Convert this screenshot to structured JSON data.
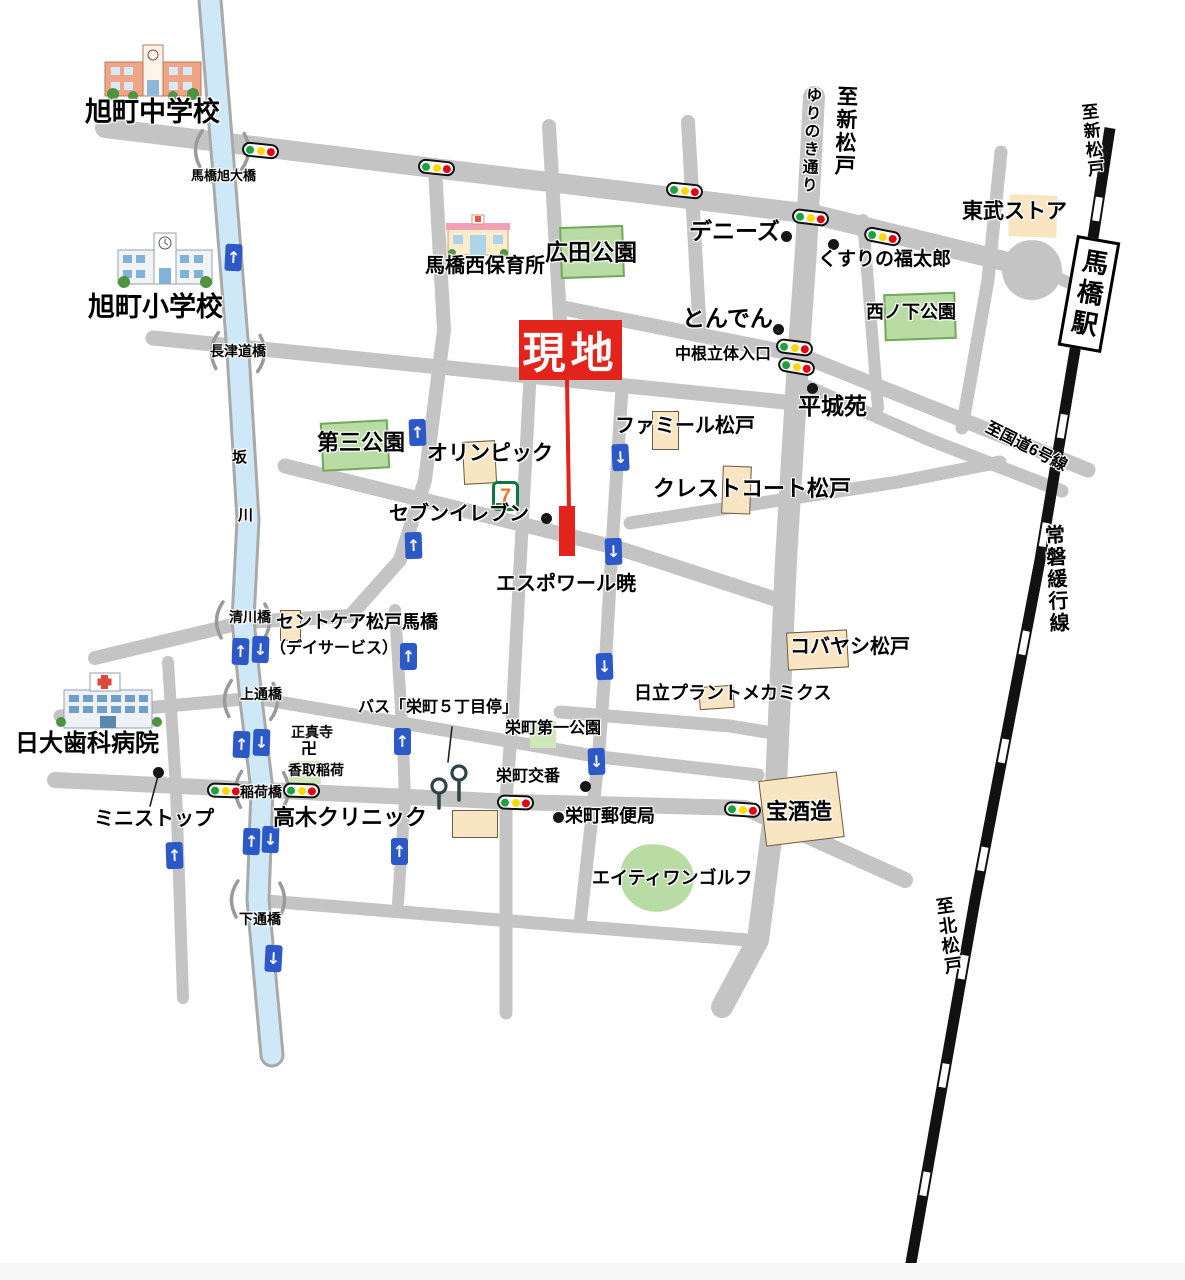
{
  "colors": {
    "road": "#c4c4c4",
    "river_fill": "#cfe8f7",
    "river_edge": "#a9a9a9",
    "rail": "#111111",
    "park_fill": "#b9dba4",
    "park_border": "#74a85e",
    "park_fill_light": "#cfe7b9",
    "building_fill": "#fae5c3",
    "building_border": "#6b5b45",
    "site_red": "#e2241d",
    "arrow_blue": "#2d59c8",
    "light_green": "#1ca23c",
    "light_yellow": "#ffd800",
    "light_red": "#e60012",
    "text": "#000000"
  },
  "site": {
    "label": "現地",
    "x": 519,
    "y": 320,
    "w": 103,
    "h": 60
  },
  "station": {
    "label": "馬橋駅",
    "x": 1067,
    "y": 238,
    "w": 44,
    "h": 112,
    "r": 10
  },
  "labels": [
    {
      "n": "asahicho-junior-high-label",
      "t": "旭町中学校",
      "x": 85,
      "y": 98,
      "s": 27
    },
    {
      "n": "asahicho-elementary-label",
      "t": "旭町小学校",
      "x": 88,
      "y": 293,
      "s": 27
    },
    {
      "n": "mabashi-asahi-ohashi-label",
      "t": "馬橋旭大橋",
      "x": 191,
      "y": 169,
      "s": 13
    },
    {
      "n": "mabashi-nishi-hoikusho-label",
      "t": "馬橋西保育所",
      "x": 425,
      "y": 256,
      "s": 20
    },
    {
      "n": "hirota-park-label",
      "t": "広田公園",
      "x": 545,
      "y": 240,
      "s": 23
    },
    {
      "n": "dennys-label",
      "t": "デニーズ",
      "x": 689,
      "y": 219,
      "s": 23
    },
    {
      "n": "yurinoki-street-label",
      "t": "ゆりのき通り",
      "x": 803,
      "y": 86,
      "s": 16,
      "v": 1,
      "r": 3
    },
    {
      "n": "to-shin-matsudo-road-label",
      "t": "至新松戸",
      "x": 835,
      "y": 85,
      "s": 21,
      "v": 1,
      "r": 2
    },
    {
      "n": "kusuri-no-fukutaro-label",
      "t": "くすりの福太郎",
      "x": 818,
      "y": 250,
      "s": 19
    },
    {
      "n": "tobu-store-label",
      "t": "東武ストア",
      "x": 962,
      "y": 201,
      "s": 21
    },
    {
      "n": "tonden-label",
      "t": "とんでん",
      "x": 682,
      "y": 306,
      "s": 23
    },
    {
      "n": "nakane-rittai-entrance-label",
      "t": "中根立体入口",
      "x": 675,
      "y": 347,
      "s": 16
    },
    {
      "n": "nishinoshita-park-label",
      "t": "西ノ下公園",
      "x": 866,
      "y": 303,
      "s": 18
    },
    {
      "n": "heijoen-label",
      "t": "平城苑",
      "x": 798,
      "y": 394,
      "s": 23
    },
    {
      "n": "to-route6-label",
      "t": "至国道6号線",
      "x": 990,
      "y": 420,
      "s": 16,
      "r": 27
    },
    {
      "n": "famille-matsudo-label",
      "t": "ファミール松戸",
      "x": 615,
      "y": 416,
      "s": 20
    },
    {
      "n": "daisan-park-label",
      "t": "第三公園",
      "x": 317,
      "y": 431,
      "s": 22
    },
    {
      "n": "olympic-label",
      "t": "オリンピック",
      "x": 427,
      "y": 443,
      "s": 21
    },
    {
      "n": "crest-court-matsudo-label",
      "t": "クレストコート松戸",
      "x": 653,
      "y": 477,
      "s": 22
    },
    {
      "n": "seven-eleven-label",
      "t": "セブンイレブン",
      "x": 389,
      "y": 504,
      "s": 20
    },
    {
      "n": "espoir-akatsuki-label",
      "t": "エスポワール暁",
      "x": 496,
      "y": 574,
      "s": 20
    },
    {
      "n": "joban-local-line-label",
      "t": "常磐緩行線",
      "x": 1041,
      "y": 525,
      "s": 20,
      "v": 1,
      "r": -3
    },
    {
      "n": "saintcare-matsudo-mabashi-label",
      "t": "セントケア松戸馬橋",
      "x": 276,
      "y": 613,
      "s": 18
    },
    {
      "n": "dayservice-label",
      "t": "（デイサービス）",
      "x": 270,
      "y": 641,
      "s": 16
    },
    {
      "n": "kiyokawa-bridge-label",
      "t": "清川橋",
      "x": 229,
      "y": 610,
      "s": 14
    },
    {
      "n": "nagatsudo-bridge-label",
      "t": "長津道橋",
      "x": 210,
      "y": 344,
      "s": 14
    },
    {
      "n": "kobayashi-matsudo-label",
      "t": "コバヤシ松戸",
      "x": 790,
      "y": 637,
      "s": 20
    },
    {
      "n": "hitachi-plant-mechanics-label",
      "t": "日立プラントメカミクス",
      "x": 634,
      "y": 684,
      "s": 18
    },
    {
      "n": "kamitsuri-bridge-label",
      "t": "上通橋",
      "x": 240,
      "y": 687,
      "s": 14
    },
    {
      "n": "shoshinji-temple-label",
      "t": "正真寺",
      "x": 291,
      "y": 725,
      "s": 14
    },
    {
      "n": "manji-symbol",
      "t": "卍",
      "x": 301,
      "y": 742,
      "s": 16
    },
    {
      "n": "katori-inari-label",
      "t": "香取稲荷",
      "x": 288,
      "y": 763,
      "s": 14
    },
    {
      "n": "bus-sakaemachi-5chome-stop-label",
      "t": "バス「栄町５丁目停」",
      "x": 358,
      "y": 700,
      "s": 16
    },
    {
      "n": "sakaemachi-daiichi-park-label",
      "t": "栄町第一公園",
      "x": 505,
      "y": 721,
      "s": 16
    },
    {
      "n": "nichidai-dental-hospital-label",
      "t": "日大歯科病院",
      "x": 15,
      "y": 731,
      "s": 24
    },
    {
      "n": "ministop-label",
      "t": "ミニストップ",
      "x": 94,
      "y": 809,
      "s": 20
    },
    {
      "n": "inari-bridge-label",
      "t": "稲荷橋",
      "x": 240,
      "y": 785,
      "s": 14
    },
    {
      "n": "takagi-clinic-label",
      "t": "高木クリニック",
      "x": 273,
      "y": 806,
      "s": 22
    },
    {
      "n": "sakaemachi-koban-label",
      "t": "栄町交番",
      "x": 496,
      "y": 769,
      "s": 16
    },
    {
      "n": "sakaemachi-post-office-label",
      "t": "栄町郵便局",
      "x": 565,
      "y": 807,
      "s": 18
    },
    {
      "n": "takara-shuzo-label",
      "t": "宝酒造",
      "x": 766,
      "y": 800,
      "s": 22
    },
    {
      "n": "eighty-one-golf-label",
      "t": "エイティワンゴルフ",
      "x": 592,
      "y": 869,
      "s": 18
    },
    {
      "n": "saka-river-label-1",
      "t": "坂",
      "x": 232,
      "y": 450,
      "s": 15
    },
    {
      "n": "saka-river-label-2",
      "t": "川",
      "x": 238,
      "y": 508,
      "s": 15
    },
    {
      "n": "shimotsuri-bridge-label",
      "t": "下通橋",
      "x": 239,
      "y": 912,
      "s": 14
    },
    {
      "n": "to-kita-matsudo-label",
      "t": "至北松戸",
      "x": 933,
      "y": 898,
      "s": 18,
      "v": 1,
      "r": -8
    },
    {
      "n": "to-shin-matsudo-rail-label",
      "t": "至新松戸",
      "x": 1078,
      "y": 104,
      "s": 17,
      "v": 1,
      "r": -6
    }
  ],
  "parks": [
    {
      "n": "hirota-park-area",
      "x": 560,
      "y": 226,
      "w": 64,
      "h": 52,
      "r": -2,
      "b": 1
    },
    {
      "n": "daisan-park-area",
      "x": 321,
      "y": 421,
      "w": 68,
      "h": 49,
      "r": -3,
      "b": 1
    },
    {
      "n": "nishinoshita-park-area",
      "x": 884,
      "y": 293,
      "w": 72,
      "h": 47,
      "r": -2,
      "b": 1
    },
    {
      "n": "sakaemachi-daiichi-park-area",
      "x": 530,
      "y": 721,
      "w": 26,
      "h": 27,
      "r": 0,
      "b": 0
    },
    {
      "n": "katori-inari-area",
      "x": 289,
      "y": 761,
      "w": 32,
      "h": 23,
      "r": 0,
      "b": 0
    }
  ],
  "buildings": [
    {
      "n": "tobu-store-building",
      "x": 1009,
      "y": 195,
      "w": 48,
      "h": 42,
      "r": 2,
      "b": 0
    },
    {
      "n": "olympic-building",
      "x": 463,
      "y": 441,
      "w": 33,
      "h": 43,
      "r": -3,
      "b": 1
    },
    {
      "n": "famille-building",
      "x": 652,
      "y": 411,
      "w": 27,
      "h": 39,
      "r": 0,
      "b": 1
    },
    {
      "n": "crest-court-building",
      "x": 722,
      "y": 466,
      "w": 29,
      "h": 48,
      "r": 2,
      "b": 1
    },
    {
      "n": "saintcare-building",
      "x": 280,
      "y": 610,
      "w": 21,
      "h": 31,
      "r": 0,
      "b": 1
    },
    {
      "n": "kobayashi-building",
      "x": 787,
      "y": 631,
      "w": 61,
      "h": 38,
      "r": -3,
      "b": 1
    },
    {
      "n": "hitachi-building",
      "x": 699,
      "y": 686,
      "w": 35,
      "h": 23,
      "r": -4,
      "b": 1
    },
    {
      "n": "takagi-building",
      "x": 452,
      "y": 810,
      "w": 46,
      "h": 28,
      "r": 0,
      "b": 1
    },
    {
      "n": "takara-building",
      "x": 762,
      "y": 776,
      "w": 79,
      "h": 66,
      "r": -7,
      "b": 1
    }
  ],
  "traffic_lights": [
    {
      "x": 260,
      "y": 150,
      "r": 6
    },
    {
      "x": 436,
      "y": 167,
      "r": 6
    },
    {
      "x": 684,
      "y": 190,
      "r": 6
    },
    {
      "x": 810,
      "y": 217,
      "r": 7
    },
    {
      "x": 882,
      "y": 236,
      "r": 11
    },
    {
      "x": 794,
      "y": 347,
      "r": 7
    },
    {
      "x": 796,
      "y": 366,
      "r": 10
    },
    {
      "x": 225,
      "y": 790,
      "r": 2
    },
    {
      "x": 301,
      "y": 790,
      "r": 2
    },
    {
      "x": 515,
      "y": 802,
      "r": 2
    },
    {
      "x": 742,
      "y": 809,
      "r": 4
    }
  ],
  "arrows": [
    {
      "d": "up",
      "x": 233,
      "y": 257,
      "r": 3
    },
    {
      "d": "up",
      "x": 417,
      "y": 432,
      "r": -2
    },
    {
      "d": "up",
      "x": 413,
      "y": 545,
      "r": -2
    },
    {
      "d": "up",
      "x": 240,
      "y": 651,
      "r": 2
    },
    {
      "d": "down",
      "x": 260,
      "y": 649,
      "r": 2
    },
    {
      "d": "up",
      "x": 241,
      "y": 744,
      "r": 2
    },
    {
      "d": "down",
      "x": 261,
      "y": 742,
      "r": 2
    },
    {
      "d": "up",
      "x": 251,
      "y": 841,
      "r": 2
    },
    {
      "d": "down",
      "x": 270,
      "y": 839,
      "r": 2
    },
    {
      "d": "down",
      "x": 273,
      "y": 958,
      "r": 3
    },
    {
      "d": "up",
      "x": 174,
      "y": 855,
      "r": -2
    },
    {
      "d": "up",
      "x": 408,
      "y": 656,
      "r": 0
    },
    {
      "d": "up",
      "x": 402,
      "y": 741,
      "r": 0
    },
    {
      "d": "up",
      "x": 399,
      "y": 851,
      "r": 0
    },
    {
      "d": "down",
      "x": 620,
      "y": 457,
      "r": -3
    },
    {
      "d": "down",
      "x": 613,
      "y": 551,
      "r": -2
    },
    {
      "d": "down",
      "x": 604,
      "y": 666,
      "r": -2
    },
    {
      "d": "down",
      "x": 596,
      "y": 761,
      "r": -2
    }
  ],
  "dots": [
    {
      "n": "dennys-dot",
      "x": 786,
      "y": 236
    },
    {
      "n": "kusuri-no-fukutaro-dot",
      "x": 833,
      "y": 244
    },
    {
      "n": "tonden-dot",
      "x": 778,
      "y": 329
    },
    {
      "n": "heijoen-dot",
      "x": 812,
      "y": 388
    },
    {
      "n": "seven-eleven-dot",
      "x": 546,
      "y": 518
    },
    {
      "n": "ministop-dot",
      "x": 158,
      "y": 772
    },
    {
      "n": "sakaemachi-koban-dot",
      "x": 585,
      "y": 786
    },
    {
      "n": "sakaemachi-post-office-dot",
      "x": 558,
      "y": 817
    }
  ],
  "bridges": [
    {
      "n": "mabashi-asahi-ohashi-bridge",
      "x": 222,
      "y": 150,
      "r": 4
    },
    {
      "n": "nagatsudo-bridge",
      "x": 238,
      "y": 352,
      "r": 4
    },
    {
      "n": "kiyokawa-bridge",
      "x": 243,
      "y": 621,
      "r": 3
    },
    {
      "n": "kamitsuri-bridge",
      "x": 251,
      "y": 700,
      "r": 4
    },
    {
      "n": "inari-bridge",
      "x": 262,
      "y": 790,
      "r": 2
    },
    {
      "n": "shimotsuri-bridge",
      "x": 258,
      "y": 900,
      "r": 3
    }
  ],
  "leader_lines": [
    {
      "n": "ministop-leader",
      "x1": 158,
      "y1": 776,
      "x2": 150,
      "y2": 806
    },
    {
      "n": "bus-stop-leader",
      "x1": 452,
      "y1": 727,
      "x2": 448,
      "y2": 762
    }
  ],
  "bus_stops": [
    {
      "x": 439,
      "y": 786,
      "pole": 22
    },
    {
      "x": 459,
      "y": 773,
      "pole": 27
    }
  ],
  "icons": [
    {
      "id": "icon-jhs",
      "n": "junior-high-school-icon",
      "x": 103,
      "y": 42,
      "w": 100,
      "h": 58
    },
    {
      "id": "icon-es",
      "n": "elementary-school-icon",
      "x": 116,
      "y": 230,
      "w": 98,
      "h": 58
    },
    {
      "id": "icon-nursery",
      "n": "nursery-school-icon",
      "x": 446,
      "y": 213,
      "w": 64,
      "h": 44
    },
    {
      "id": "icon-hospital",
      "n": "hospital-icon",
      "x": 56,
      "y": 668,
      "w": 106,
      "h": 62
    },
    {
      "id": "icon-seven",
      "n": "seven-eleven-icon",
      "x": 492,
      "y": 481,
      "w": 27,
      "h": 30
    }
  ]
}
